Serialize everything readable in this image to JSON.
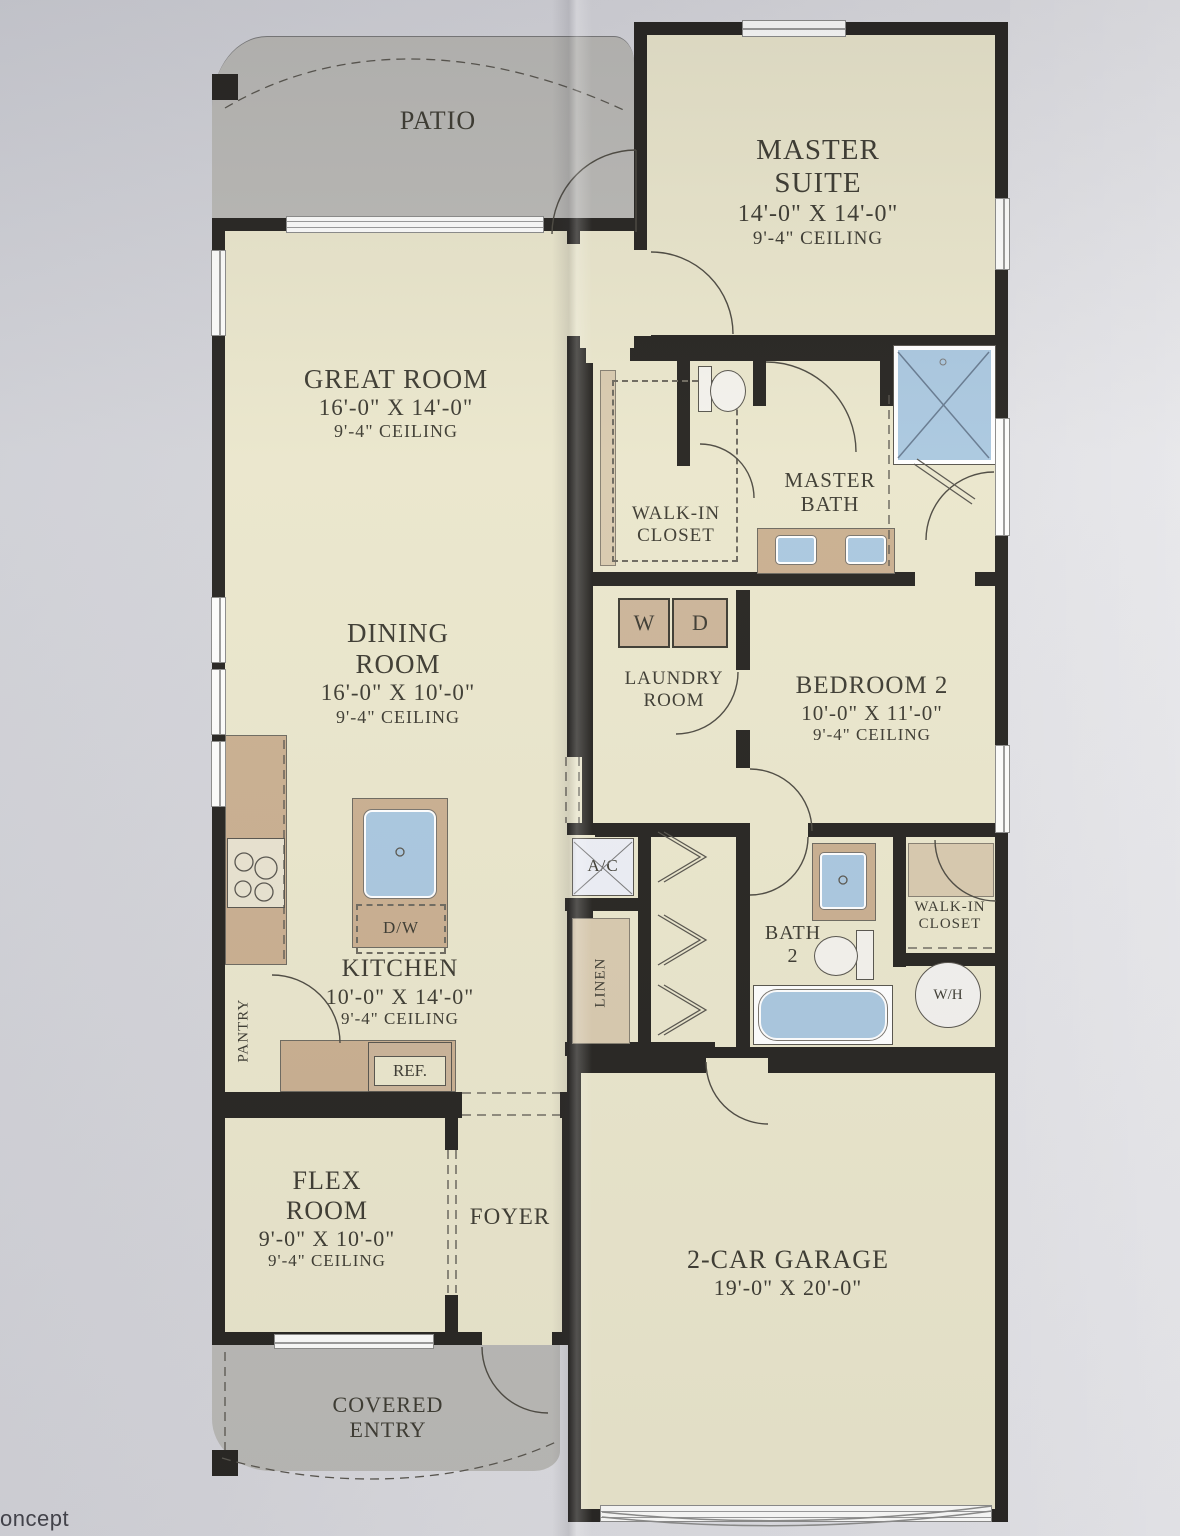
{
  "photo": {
    "annotation_partial": "oncept"
  },
  "rooms": {
    "patio": {
      "name": "PATIO"
    },
    "master_suite": {
      "name1": "MASTER",
      "name2": "SUITE",
      "dims": "14'-0\" X 14'-0\"",
      "ceiling": "9'-4\" CEILING"
    },
    "great_room": {
      "name": "GREAT ROOM",
      "dims": "16'-0\" X 14'-0\"",
      "ceiling": "9'-4\" CEILING"
    },
    "dining_room": {
      "name1": "DINING",
      "name2": "ROOM",
      "dims": "16'-0\" X 10'-0\"",
      "ceiling": "9'-4\" CEILING"
    },
    "kitchen": {
      "name": "KITCHEN",
      "dims": "10'-0\" X 14'-0\"",
      "ceiling": "9'-4\" CEILING"
    },
    "master_walk_in_closet": {
      "name1": "WALK-IN",
      "name2": "CLOSET"
    },
    "master_bath": {
      "name1": "MASTER",
      "name2": "BATH"
    },
    "laundry_room": {
      "name1": "LAUNDRY",
      "name2": "ROOM"
    },
    "bedroom_2": {
      "name": "BEDROOM 2",
      "dims": "10'-0\" X 11'-0\"",
      "ceiling": "9'-4\" CEILING"
    },
    "bath_2": {
      "name1": "BATH",
      "name2": "2"
    },
    "walk_in_closet_2": {
      "name1": "WALK-IN",
      "name2": "CLOSET"
    },
    "flex_room": {
      "name1": "FLEX",
      "name2": "ROOM",
      "dims": "9'-0\" X 10'-0\"",
      "ceiling": "9'-4\" CEILING"
    },
    "foyer": {
      "name": "FOYER"
    },
    "garage": {
      "name": "2-CAR GARAGE",
      "dims": "19'-0\" X 20'-0\""
    },
    "covered_entry": {
      "name1": "COVERED",
      "name2": "ENTRY"
    }
  },
  "fixtures": {
    "washer": "W",
    "dryer": "D",
    "dishwasher": "D/W",
    "refrigerator": "REF.",
    "pantry": "PANTRY",
    "ac_unit": "A/C",
    "linen": "LINEN",
    "water_heater": "W/H"
  },
  "colors": {
    "paper": "#d6d6da",
    "room_fill": "#eae6cb",
    "outdoor_fill": "#b9b8b4",
    "cabinet_tan": "#c9ae8e",
    "closet_tan": "#d8c9ad",
    "fixture_blue": "#a9c7df",
    "wall": "#23211d",
    "label_text": "#3a382e"
  }
}
